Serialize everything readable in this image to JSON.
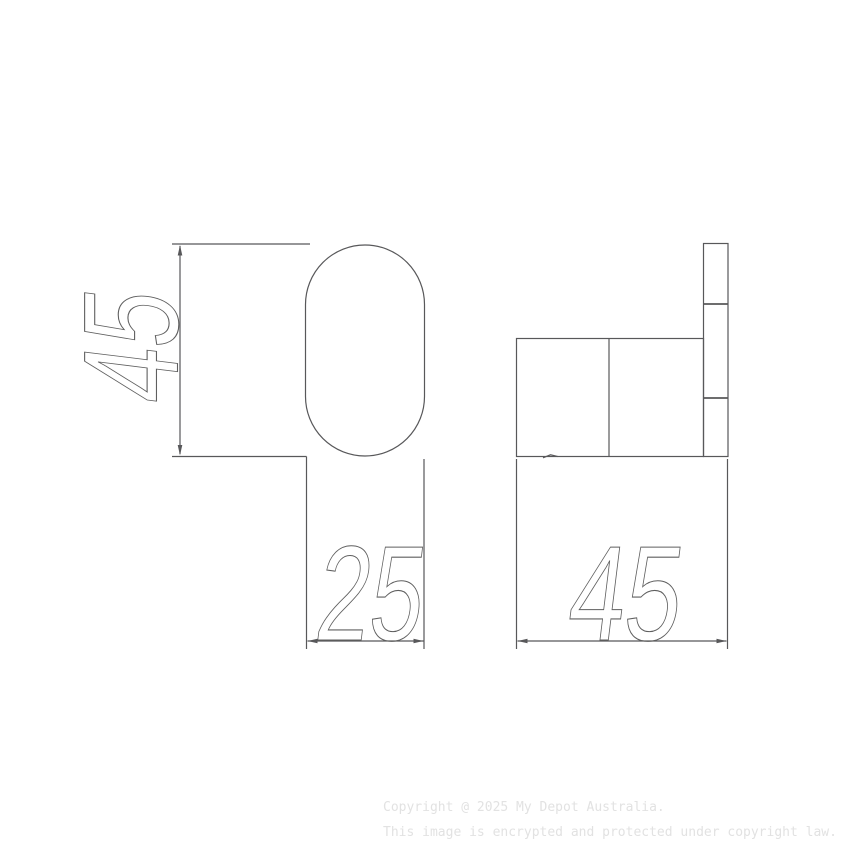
{
  "dimensions": {
    "front_height": "45",
    "front_width": "25",
    "side_depth": "45"
  },
  "watermark": {
    "line1": "Copyright @ 2025 My Depot Australia.",
    "line2": "This image is encrypted and protected under copyright law."
  },
  "colors": {
    "line": "#58585a",
    "dim_text_stroke": "#5f5f5f",
    "watermark_text": "#e2e2e2",
    "background": "#ffffff"
  }
}
